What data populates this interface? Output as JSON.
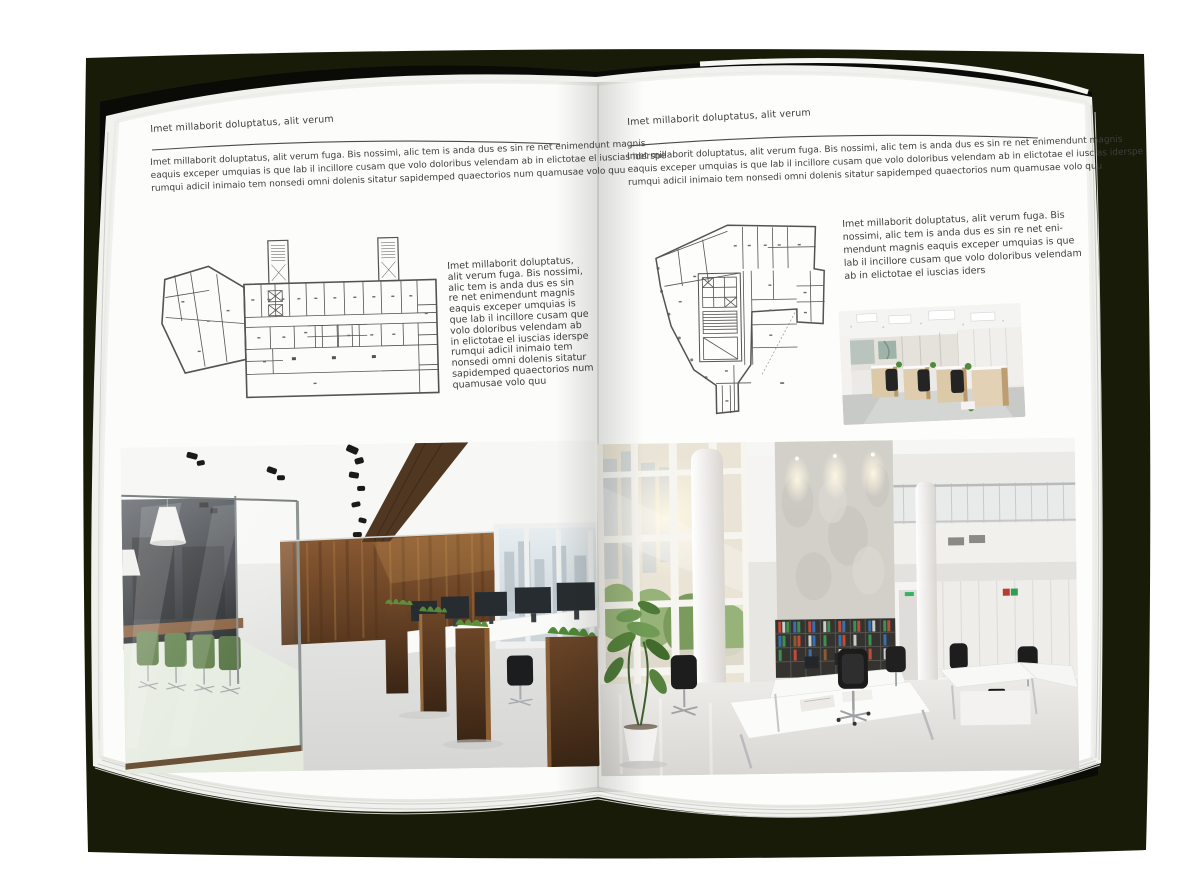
{
  "spread": {
    "left_page": {
      "header": "Imet millaborit doluptatus, alit verum",
      "intro_lines": [
        "Imet millaborit doluptatus, alit verum fuga. Bis nossimi, alic tem is anda dus es sin re net enimendunt magnis",
        "eaquis exceper umquias is que lab il incillore cusam que volo doloribus velendam ab in elictotae el iuscias iderspe",
        "rumqui adicil inimaio tem nonsedi omni dolenis sitatur sapidemped quaectorios num quamusae volo quu"
      ],
      "caption_lines": [
        "Imet millaborit doluptatus,",
        "alit verum fuga. Bis nossimi,",
        "alic tem is anda dus es sin",
        "re net enimendunt magnis",
        "eaquis exceper umquias is",
        "que lab il incillore cusam que",
        "volo doloribus velendam ab",
        "in elictotae el iuscias iderspe",
        "rumqui adicil inimaio tem",
        "nonsedi omni dolenis sitatur",
        "sapidemped quaectorios num",
        "quamusae volo quu"
      ]
    },
    "right_page": {
      "header": "Imet millaborit doluptatus, alit verum",
      "intro_lines": [
        "Imet millaborit doluptatus, alit verum fuga. Bis nossimi, alic tem is anda dus es sin re net enimendunt magnis",
        "eaquis exceper umquias is que lab il incillore cusam que volo doloribus velendam ab in elictotae el iuscias iderspe",
        "rumqui adicil inimaio tem nonsedi omni dolenis sitatur sapidemped quaectorios num quamusae volo quu"
      ],
      "caption_lines": [
        "Imet millaborit doluptatus, alit verum fuga. Bis",
        "nossimi, alic tem is anda dus es sin re net eni-",
        "mendunt magnis eaquis exceper umquias is que",
        "lab il incillore cusam que volo doloribus velendam",
        "ab in elictotae el iuscias iders"
      ]
    }
  },
  "colors": {
    "backdrop": "#191b09",
    "page": "#fcfcfa",
    "ink": "#3e3e3c",
    "rule": "#4b4b49"
  }
}
